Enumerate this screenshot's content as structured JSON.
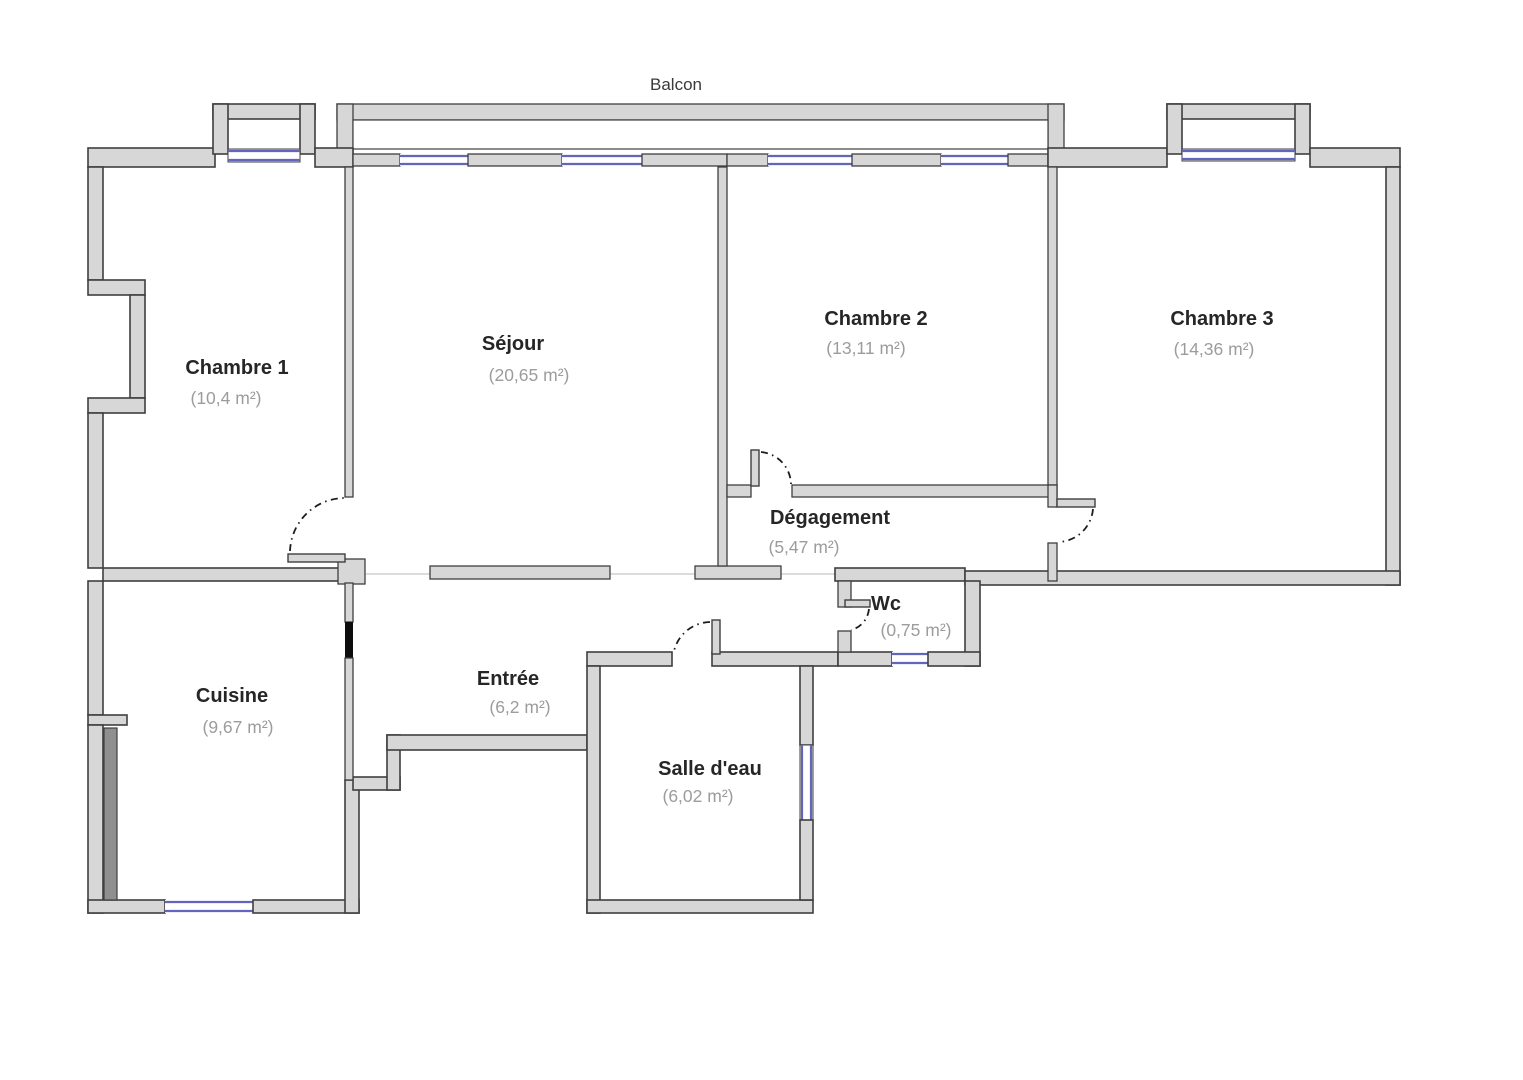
{
  "plan": {
    "balcony_label": "Balcon",
    "rooms": [
      {
        "id": "chambre1",
        "name": "Chambre 1",
        "area": "(10,4 m²)"
      },
      {
        "id": "sejour",
        "name": "Séjour",
        "area": "(20,65 m²)"
      },
      {
        "id": "chambre2",
        "name": "Chambre 2",
        "area": "(13,11 m²)"
      },
      {
        "id": "chambre3",
        "name": "Chambre 3",
        "area": "(14,36 m²)"
      },
      {
        "id": "degagement",
        "name": "Dégagement",
        "area": "(5,47 m²)"
      },
      {
        "id": "wc",
        "name": "Wc",
        "area": "(0,75 m²)"
      },
      {
        "id": "cuisine",
        "name": "Cuisine",
        "area": "(9,67 m²)"
      },
      {
        "id": "entree",
        "name": "Entrée",
        "area": "(6,2 m²)"
      },
      {
        "id": "salledeau",
        "name": "Salle d'eau",
        "area": "(6,02 m²)"
      }
    ],
    "colors": {
      "wall_fill": "#d7d7d7",
      "wall_stroke": "#3f3f3f",
      "window_color": "#6165bc",
      "opening_color": "#dcdcdc",
      "door_arc_color": "#1c1c1c",
      "room_label_color": "#262626",
      "area_label_color": "#9c9c9c",
      "solid_marker_color": "#0d0d0d",
      "radiator_color": "#8f8f8f"
    }
  }
}
